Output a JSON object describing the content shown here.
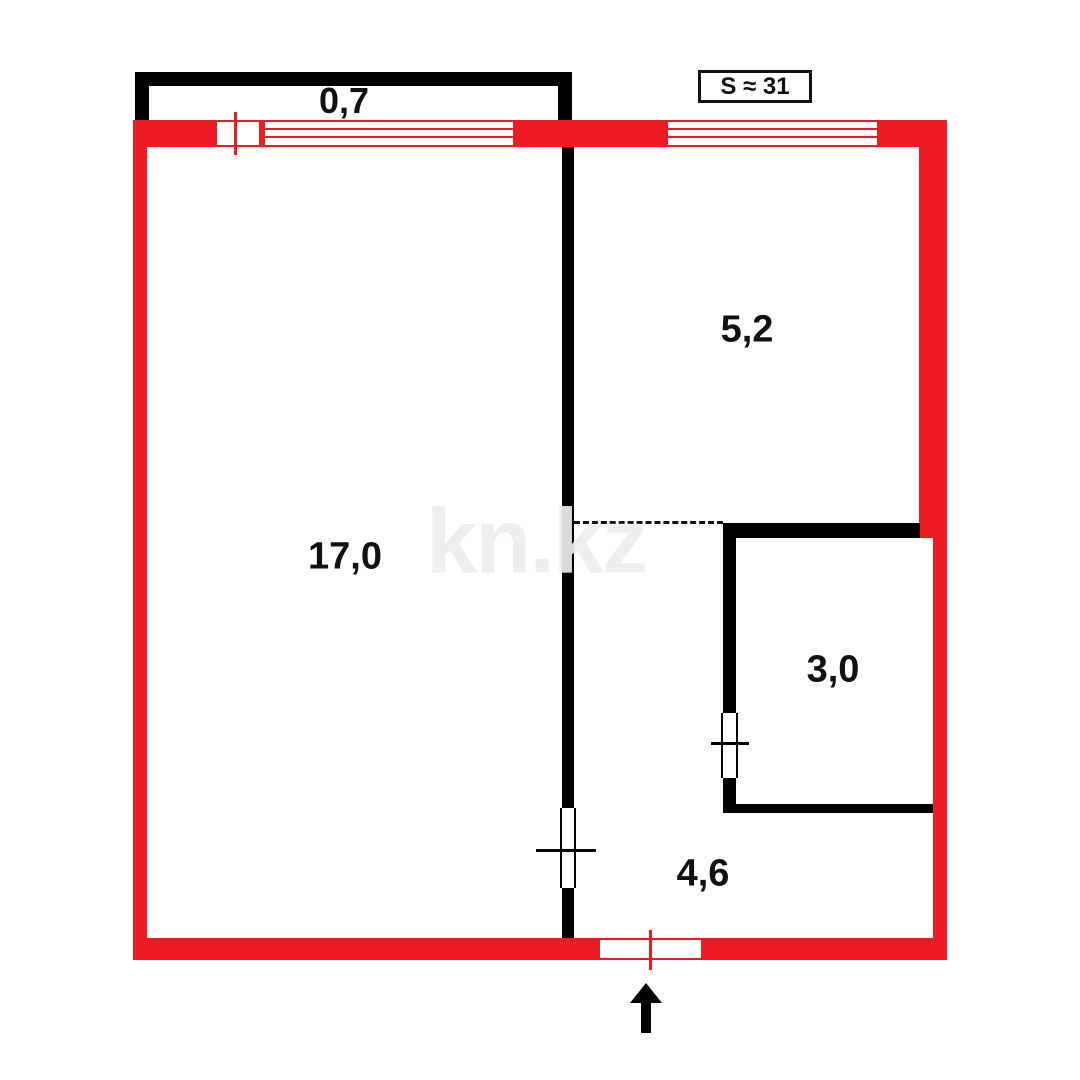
{
  "floor_plan": {
    "total_area_label": "S ≈ 31",
    "watermark": "kn.kz",
    "rooms": [
      {
        "name": "balcony",
        "area_label": "0,7"
      },
      {
        "name": "living-room",
        "area_label": "17,0"
      },
      {
        "name": "kitchen",
        "area_label": "5,2"
      },
      {
        "name": "bathroom",
        "area_label": "3,0"
      },
      {
        "name": "hallway",
        "area_label": "4,6"
      }
    ],
    "colors": {
      "exterior_wall": "#ED1C24",
      "interior_wall": "#000000",
      "watermark_gray": "#EDEDED"
    }
  }
}
